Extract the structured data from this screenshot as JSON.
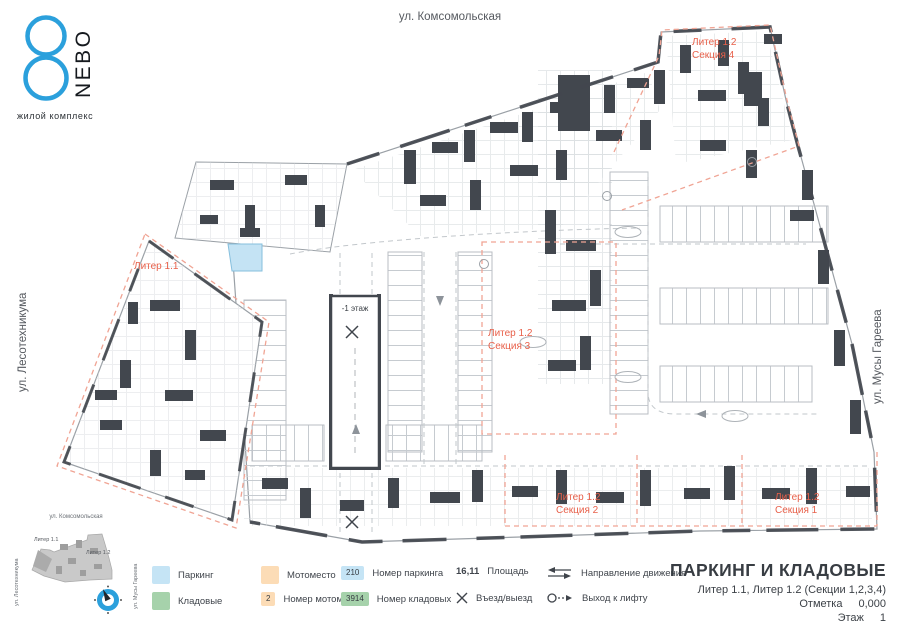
{
  "logo": {
    "figure": "8",
    "name": "NEBO",
    "tagline": "жилой комплекс",
    "accent_color": "#2ba0dc"
  },
  "streets": {
    "top": "ул. Комсомольская",
    "left": "ул. Лесотехникума",
    "right": "ул. Мусы Гареева"
  },
  "plan": {
    "labels": {
      "liter11": "Литер 1.1",
      "s4_line1": "Литер 1.2",
      "s4_line2": "Секция 4",
      "s3_line1": "Литер 1.2",
      "s3_line2": "Секция 3",
      "s2_line1": "Литер 1.2",
      "s2_line2": "Секция 2",
      "s1_line1": "Литер 1.2",
      "s1_line2": "Секция 1",
      "ramp": "-1 этаж"
    },
    "colors": {
      "section_label": "#e8604a",
      "boundary_dash": "#f0a494",
      "wall": "#42474e",
      "selected_parking": "#c4e3f4"
    }
  },
  "minimap": {
    "street_top": "ул. Комсомольская",
    "street_left": "ул. Лесотехникума",
    "street_right": "ул. Мусы Гареева",
    "liter11": "Литер 1.1",
    "liter12": "Литер 1.2"
  },
  "legend": {
    "items": [
      {
        "label": "Паркинг"
      },
      {
        "label": "Кладовые"
      },
      {
        "label": "Мотоместо"
      },
      {
        "label": "Номер мотоместа",
        "badge": "2"
      },
      {
        "label": "Номер паркинга",
        "badge": "210"
      },
      {
        "label": "Номер кладовых",
        "badge": "3914"
      },
      {
        "label": "Площадь",
        "value": "16,11"
      },
      {
        "label": "Въезд/выезд"
      },
      {
        "label": "Направление движения"
      },
      {
        "label": "Выход к лифту"
      }
    ],
    "colors": {
      "parking": "#c5e4f5",
      "moto": "#fcdcb6",
      "storage": "#a6d2ab"
    }
  },
  "titleblock": {
    "title": "ПАРКИНГ И КЛАДОВЫЕ",
    "subtitle": "Литер 1.1, Литер 1.2 (Секции 1,2,3,4)",
    "mark_label": "Отметка",
    "mark_value": "0,000",
    "floor_label": "Этаж",
    "floor_value": "1"
  }
}
